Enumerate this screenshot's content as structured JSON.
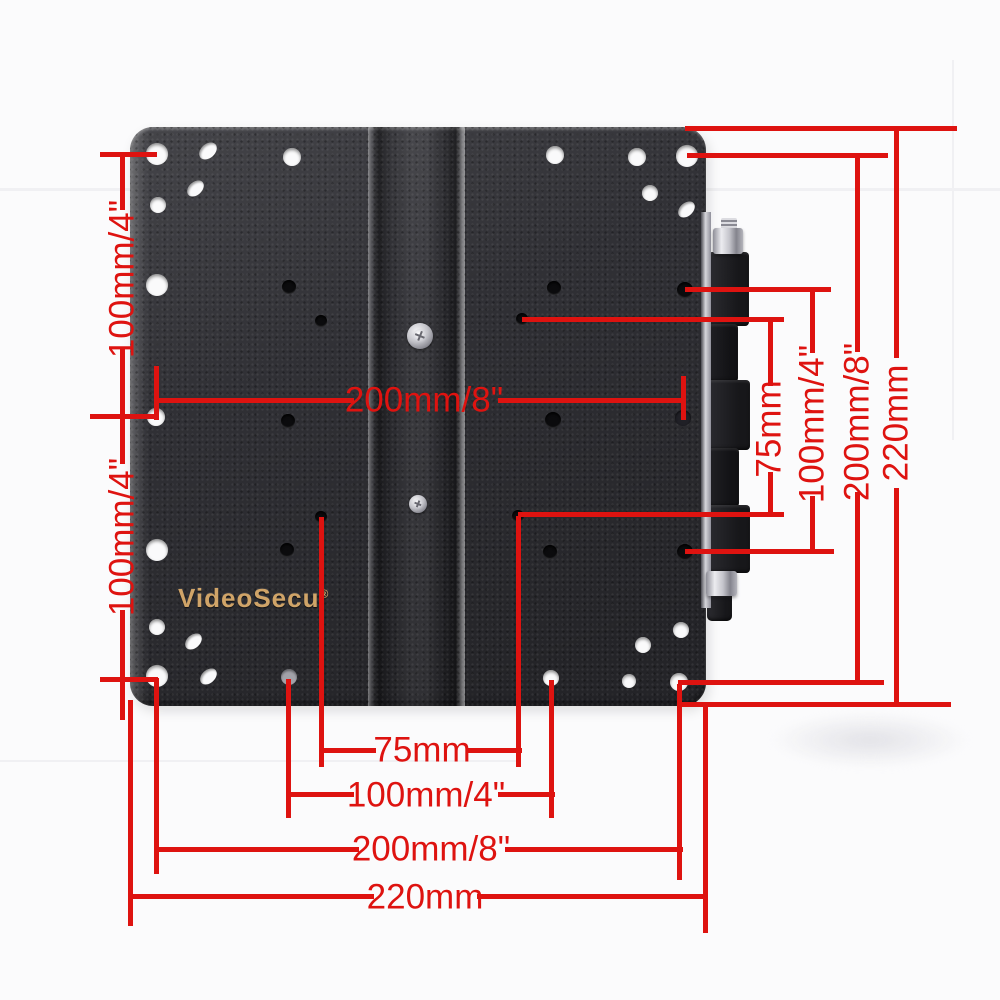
{
  "brand": {
    "name": "VideoSecu",
    "mark": "®"
  },
  "dims": {
    "left_top": "100mm/4\"",
    "left_bottom": "100mm/4\"",
    "center": "200mm/8\"",
    "right_75": "75mm",
    "right_100": "100mm/4\"",
    "right_200": "200mm/8\"",
    "right_220": "220mm",
    "bottom_75": "75mm",
    "bottom_100": "100mm/4\"",
    "bottom_200": "200mm/8\"",
    "bottom_220": "220mm"
  },
  "colors": {
    "dimension_red": "#de1310",
    "logo_gold": "#d0a468",
    "plate_dark": "#303035",
    "background": "#fbfbfc"
  }
}
